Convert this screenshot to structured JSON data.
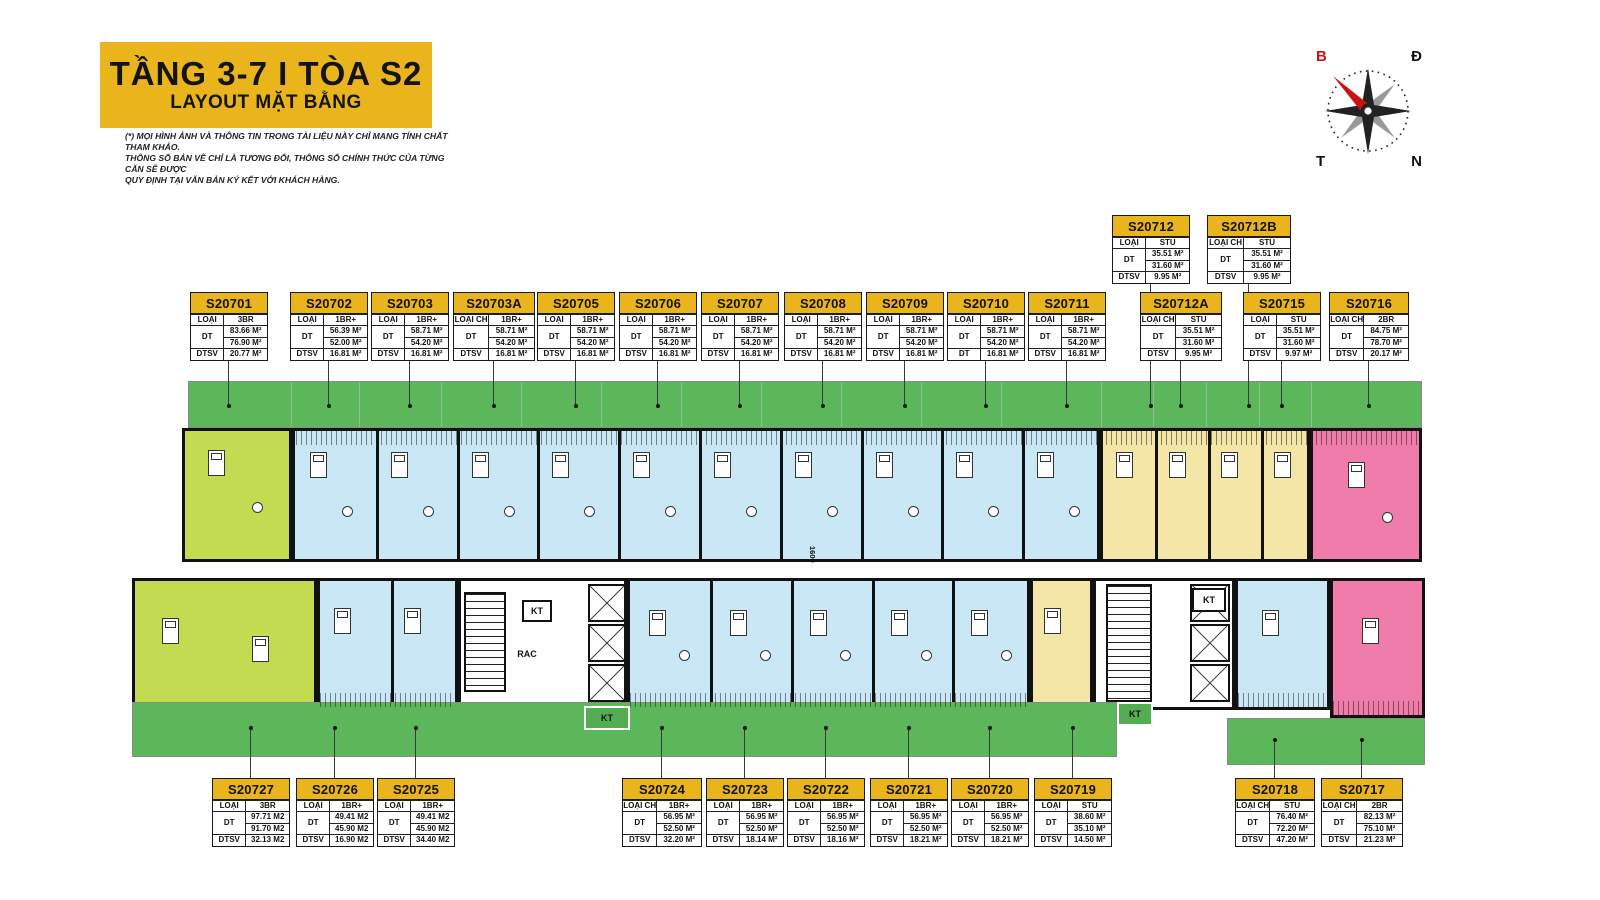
{
  "header": {
    "title": "TẦNG 3-7 I TÒA S2",
    "subtitle": "LAYOUT MẶT BẰNG",
    "disclaimer_line1": "(*) MỌI HÌNH ẢNH VÀ THÔNG TIN TRONG TÀI LIỆU NÀY CHỈ MANG TÍNH CHẤT THAM KHẢO.",
    "disclaimer_line2": "THÔNG SỐ BẢN VẼ CHỈ LÀ TƯƠNG ĐỐI, THÔNG SỐ CHÍNH THỨC CỦA TỪNG CĂN SẼ ĐƯỢC",
    "disclaimer_line3": "QUY ĐỊNH TẠI VĂN BẢN KÝ KẾT VỚI KHÁCH HÀNG."
  },
  "compass": {
    "north": "B",
    "east": "Đ",
    "west": "T",
    "south": "N"
  },
  "labels": {
    "loai_ch": "LOẠI CH",
    "dt": "DT",
    "dtsv": "DTSV",
    "kt": "KT",
    "rac": "RAC",
    "corridor_dim": "1600"
  },
  "colors": {
    "accent_gold": "#E9B41C",
    "landscape_green": "#5CB75A",
    "unit_3br_lime": "#C3DB51",
    "unit_1br_blue": "#C9E7F4",
    "unit_stu_yellow": "#F3E6A6",
    "unit_2br_pink": "#F07CAB",
    "wall_black": "#111111",
    "compass_red": "#CC1111"
  },
  "units": [
    {
      "code": "S20701",
      "type": "3BR",
      "dt1": "83.66 M²",
      "dt2": "76.90 M²",
      "r4": "DTSV",
      "dtsv": "20.77 M²"
    },
    {
      "code": "S20702",
      "type": "1BR+",
      "dt1": "56.39 M²",
      "dt2": "52.00 M²",
      "r4": "DTSV",
      "dtsv": "16.81 M²"
    },
    {
      "code": "S20703",
      "type": "1BR+",
      "dt1": "58.71 M²",
      "dt2": "54.20 M²",
      "r4": "DTSV",
      "dtsv": "16.81 M²"
    },
    {
      "code": "S20703A",
      "type": "1BR+",
      "dt1": "58.71 M²",
      "dt2": "54.20 M²",
      "r4": "DTSV",
      "dtsv": "16.81 M²"
    },
    {
      "code": "S20705",
      "type": "1BR+",
      "dt1": "58.71 M²",
      "dt2": "54.20 M²",
      "r4": "DTSV",
      "dtsv": "16.81 M²"
    },
    {
      "code": "S20706",
      "type": "1BR+",
      "dt1": "58.71 M²",
      "dt2": "54.20 M²",
      "r4": "DTSV",
      "dtsv": "16.81 M²"
    },
    {
      "code": "S20707",
      "type": "1BR+",
      "dt1": "58.71 M²",
      "dt2": "54.20 M²",
      "r4": "DTSV",
      "dtsv": "16.81 M²"
    },
    {
      "code": "S20708",
      "type": "1BR+",
      "dt1": "58.71 M²",
      "dt2": "54.20 M²",
      "r4": "DTSV",
      "dtsv": "16.81 M²"
    },
    {
      "code": "S20709",
      "type": "1BR+",
      "dt1": "58.71 M²",
      "dt2": "54.20 M²",
      "r4": "DTSV",
      "dtsv": "16.81 M²"
    },
    {
      "code": "S20710",
      "type": "1BR+",
      "dt1": "58.71 M²",
      "dt2": "54.20 M²",
      "r4": "DT",
      "dtsv": "16.81 M²"
    },
    {
      "code": "S20711",
      "type": "1BR+",
      "dt1": "58.71 M²",
      "dt2": "54.20 M²",
      "r4": "DTSV",
      "dtsv": "16.81 M²"
    },
    {
      "code": "S20712",
      "type": "STU",
      "dt1": "35.51 M²",
      "dt2": "31.60 M²",
      "r4": "DTSV",
      "dtsv": "9.95 M²"
    },
    {
      "code": "S20712B",
      "type": "STU",
      "dt1": "35.51 M²",
      "dt2": "31.60 M²",
      "r4": "DTSV",
      "dtsv": "9.95 M²"
    },
    {
      "code": "S20712A",
      "type": "STU",
      "dt1": "35.51 M²",
      "dt2": "31.60 M²",
      "r4": "DTSV",
      "dtsv": "9.95 M²"
    },
    {
      "code": "S20715",
      "type": "STU",
      "dt1": "35.51 M²",
      "dt2": "31.60 M²",
      "r4": "DTSV",
      "dtsv": "9.97 M²"
    },
    {
      "code": "S20716",
      "type": "2BR",
      "dt1": "84.75 M²",
      "dt2": "78.70 M²",
      "r4": "DTSV",
      "dtsv": "20.17 M²"
    },
    {
      "code": "S20727",
      "type": "3BR",
      "dt1": "97.71 M2",
      "dt2": "91.70 M2",
      "r4": "DTSV",
      "dtsv": "32.13 M2"
    },
    {
      "code": "S20726",
      "type": "1BR+",
      "dt1": "49.41 M2",
      "dt2": "45.90 M2",
      "r4": "DTSV",
      "dtsv": "16.90 M2"
    },
    {
      "code": "S20725",
      "type": "1BR+",
      "dt1": "49.41 M2",
      "dt2": "45.90 M2",
      "r4": "DTSV",
      "dtsv": "34.40 M2"
    },
    {
      "code": "S20724",
      "type": "1BR+",
      "dt1": "56.95 M²",
      "dt2": "52.50 M²",
      "r4": "DTSV",
      "dtsv": "32.20 M²"
    },
    {
      "code": "S20723",
      "type": "1BR+",
      "dt1": "56.95 M²",
      "dt2": "52.50 M²",
      "r4": "DTSV",
      "dtsv": "18.14 M²"
    },
    {
      "code": "S20722",
      "type": "1BR+",
      "dt1": "56.95 M²",
      "dt2": "52.50 M²",
      "r4": "DTSV",
      "dtsv": "18.16 M²"
    },
    {
      "code": "S20721",
      "type": "1BR+",
      "dt1": "56.95 M²",
      "dt2": "52.50 M²",
      "r4": "DTSV",
      "dtsv": "18.21 M²"
    },
    {
      "code": "S20720",
      "type": "1BR+",
      "dt1": "56.95 M²",
      "dt2": "52.50 M²",
      "r4": "DTSV",
      "dtsv": "18.21 M²"
    },
    {
      "code": "S20719",
      "type": "STU",
      "dt1": "38.60 M²",
      "dt2": "35.10 M²",
      "r4": "DTSV",
      "dtsv": "14.50 M²"
    },
    {
      "code": "S20718",
      "type": "STU",
      "dt1": "76.40 M²",
      "dt2": "72.20 M²",
      "r4": "DTSV",
      "dtsv": "47.20 M²"
    },
    {
      "code": "S20717",
      "type": "2BR",
      "dt1": "82.13 M²",
      "dt2": "75.10 M²",
      "r4": "DTSV",
      "dtsv": "21.23 M²"
    }
  ]
}
